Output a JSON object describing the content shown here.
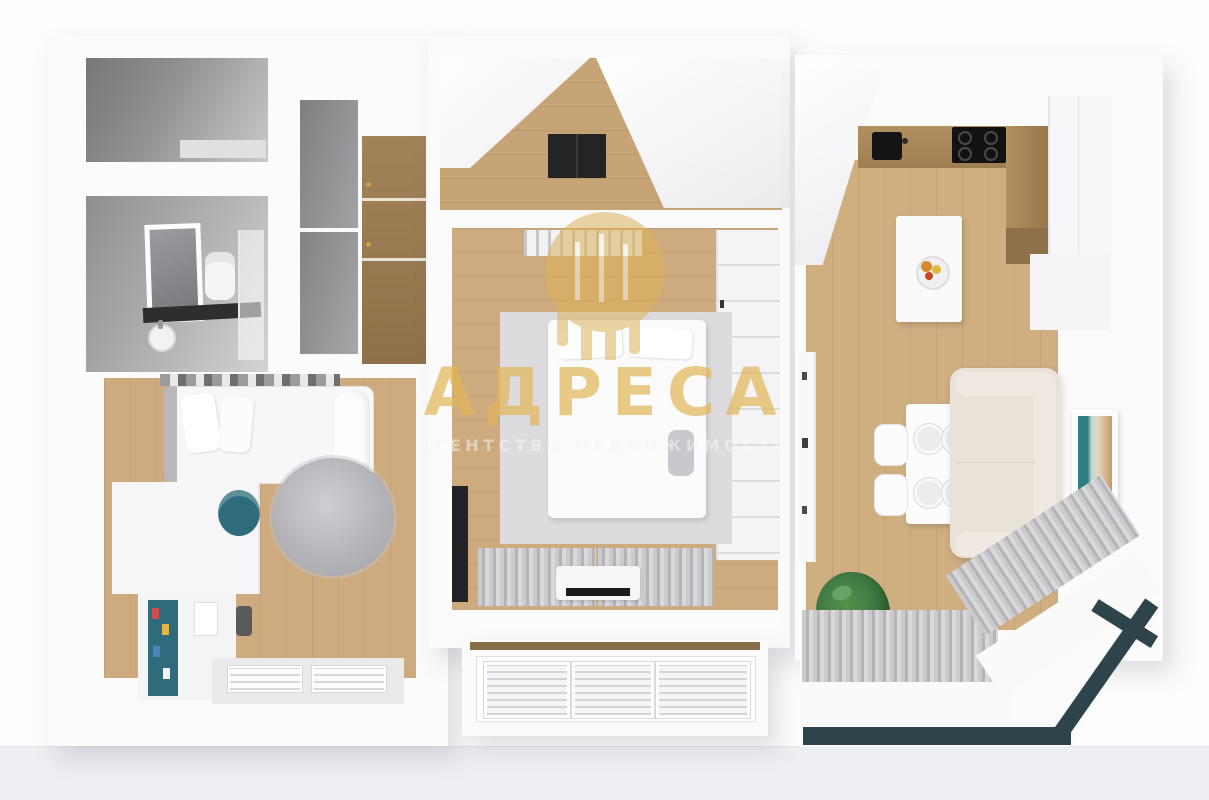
{
  "watermark": {
    "title": "АДРЕСА",
    "subtitle": "АГЕНТСТВО НЕДВИЖИМОСТИ",
    "logo_icon": "building-columns-logo-icon",
    "title_color": "#e0b658",
    "subtitle_color": "#f5f3f0"
  },
  "scene": {
    "type": "3d-floor-plan-top-view-render",
    "rooms": [
      {
        "name": "toilet",
        "position": "top-left"
      },
      {
        "name": "bathroom",
        "position": "left",
        "furniture": [
          "mirror",
          "vanity-counter",
          "sink",
          "toilet",
          "towel-dryer"
        ]
      },
      {
        "name": "hallway-closet",
        "position": "top-left-center",
        "furniture": [
          "wardrobe-wood",
          "closet-panels"
        ]
      },
      {
        "name": "entrance-hall",
        "position": "top-center",
        "furniture": [
          "doormat"
        ]
      },
      {
        "name": "bedroom",
        "position": "center",
        "furniture": [
          "double-bed",
          "area-rug",
          "wardrobe",
          "wall-tv",
          "curtains",
          "tv-dresser"
        ]
      },
      {
        "name": "kids-room",
        "position": "bottom-left",
        "furniture": [
          "single-bed",
          "round-rug",
          "desk-unit",
          "teal-shelf",
          "window"
        ]
      },
      {
        "name": "living-room-kitchen",
        "position": "right",
        "furniture": [
          "kitchen-counter",
          "sink",
          "cooktop",
          "tall-cabinets",
          "island-with-fruit-bowl",
          "dining-table",
          "chairs",
          "plates",
          "sofa",
          "wall-art",
          "plant",
          "media-console",
          "bay-curtains"
        ]
      },
      {
        "name": "loggia-window",
        "position": "bottom-center"
      },
      {
        "name": "balcony",
        "position": "bottom-right"
      }
    ]
  },
  "colors": {
    "background": "#fdfdfe",
    "backdrop_band": "#edeff2",
    "wall_white": "#f7f7f9",
    "wood_floor": "#cdab7e",
    "counter_wood": "#a8895c",
    "wardrobe_wood": "#9a7c52",
    "bath_wall_gray": "#8f8f92",
    "bedroom_rug": "#dcdcdf",
    "round_rug": "#b5b5ba",
    "sofa_beige": "#e9e2d9",
    "curtain_gray": "#c6c6c9",
    "balcony_frame_teal": "#2e444b",
    "kids_shelf_teal": "#2d6b7d",
    "doormat_black": "#222426",
    "appliance_black": "#141416",
    "plant_green": "#3c7540",
    "watermark_gold": "#e0b658"
  }
}
